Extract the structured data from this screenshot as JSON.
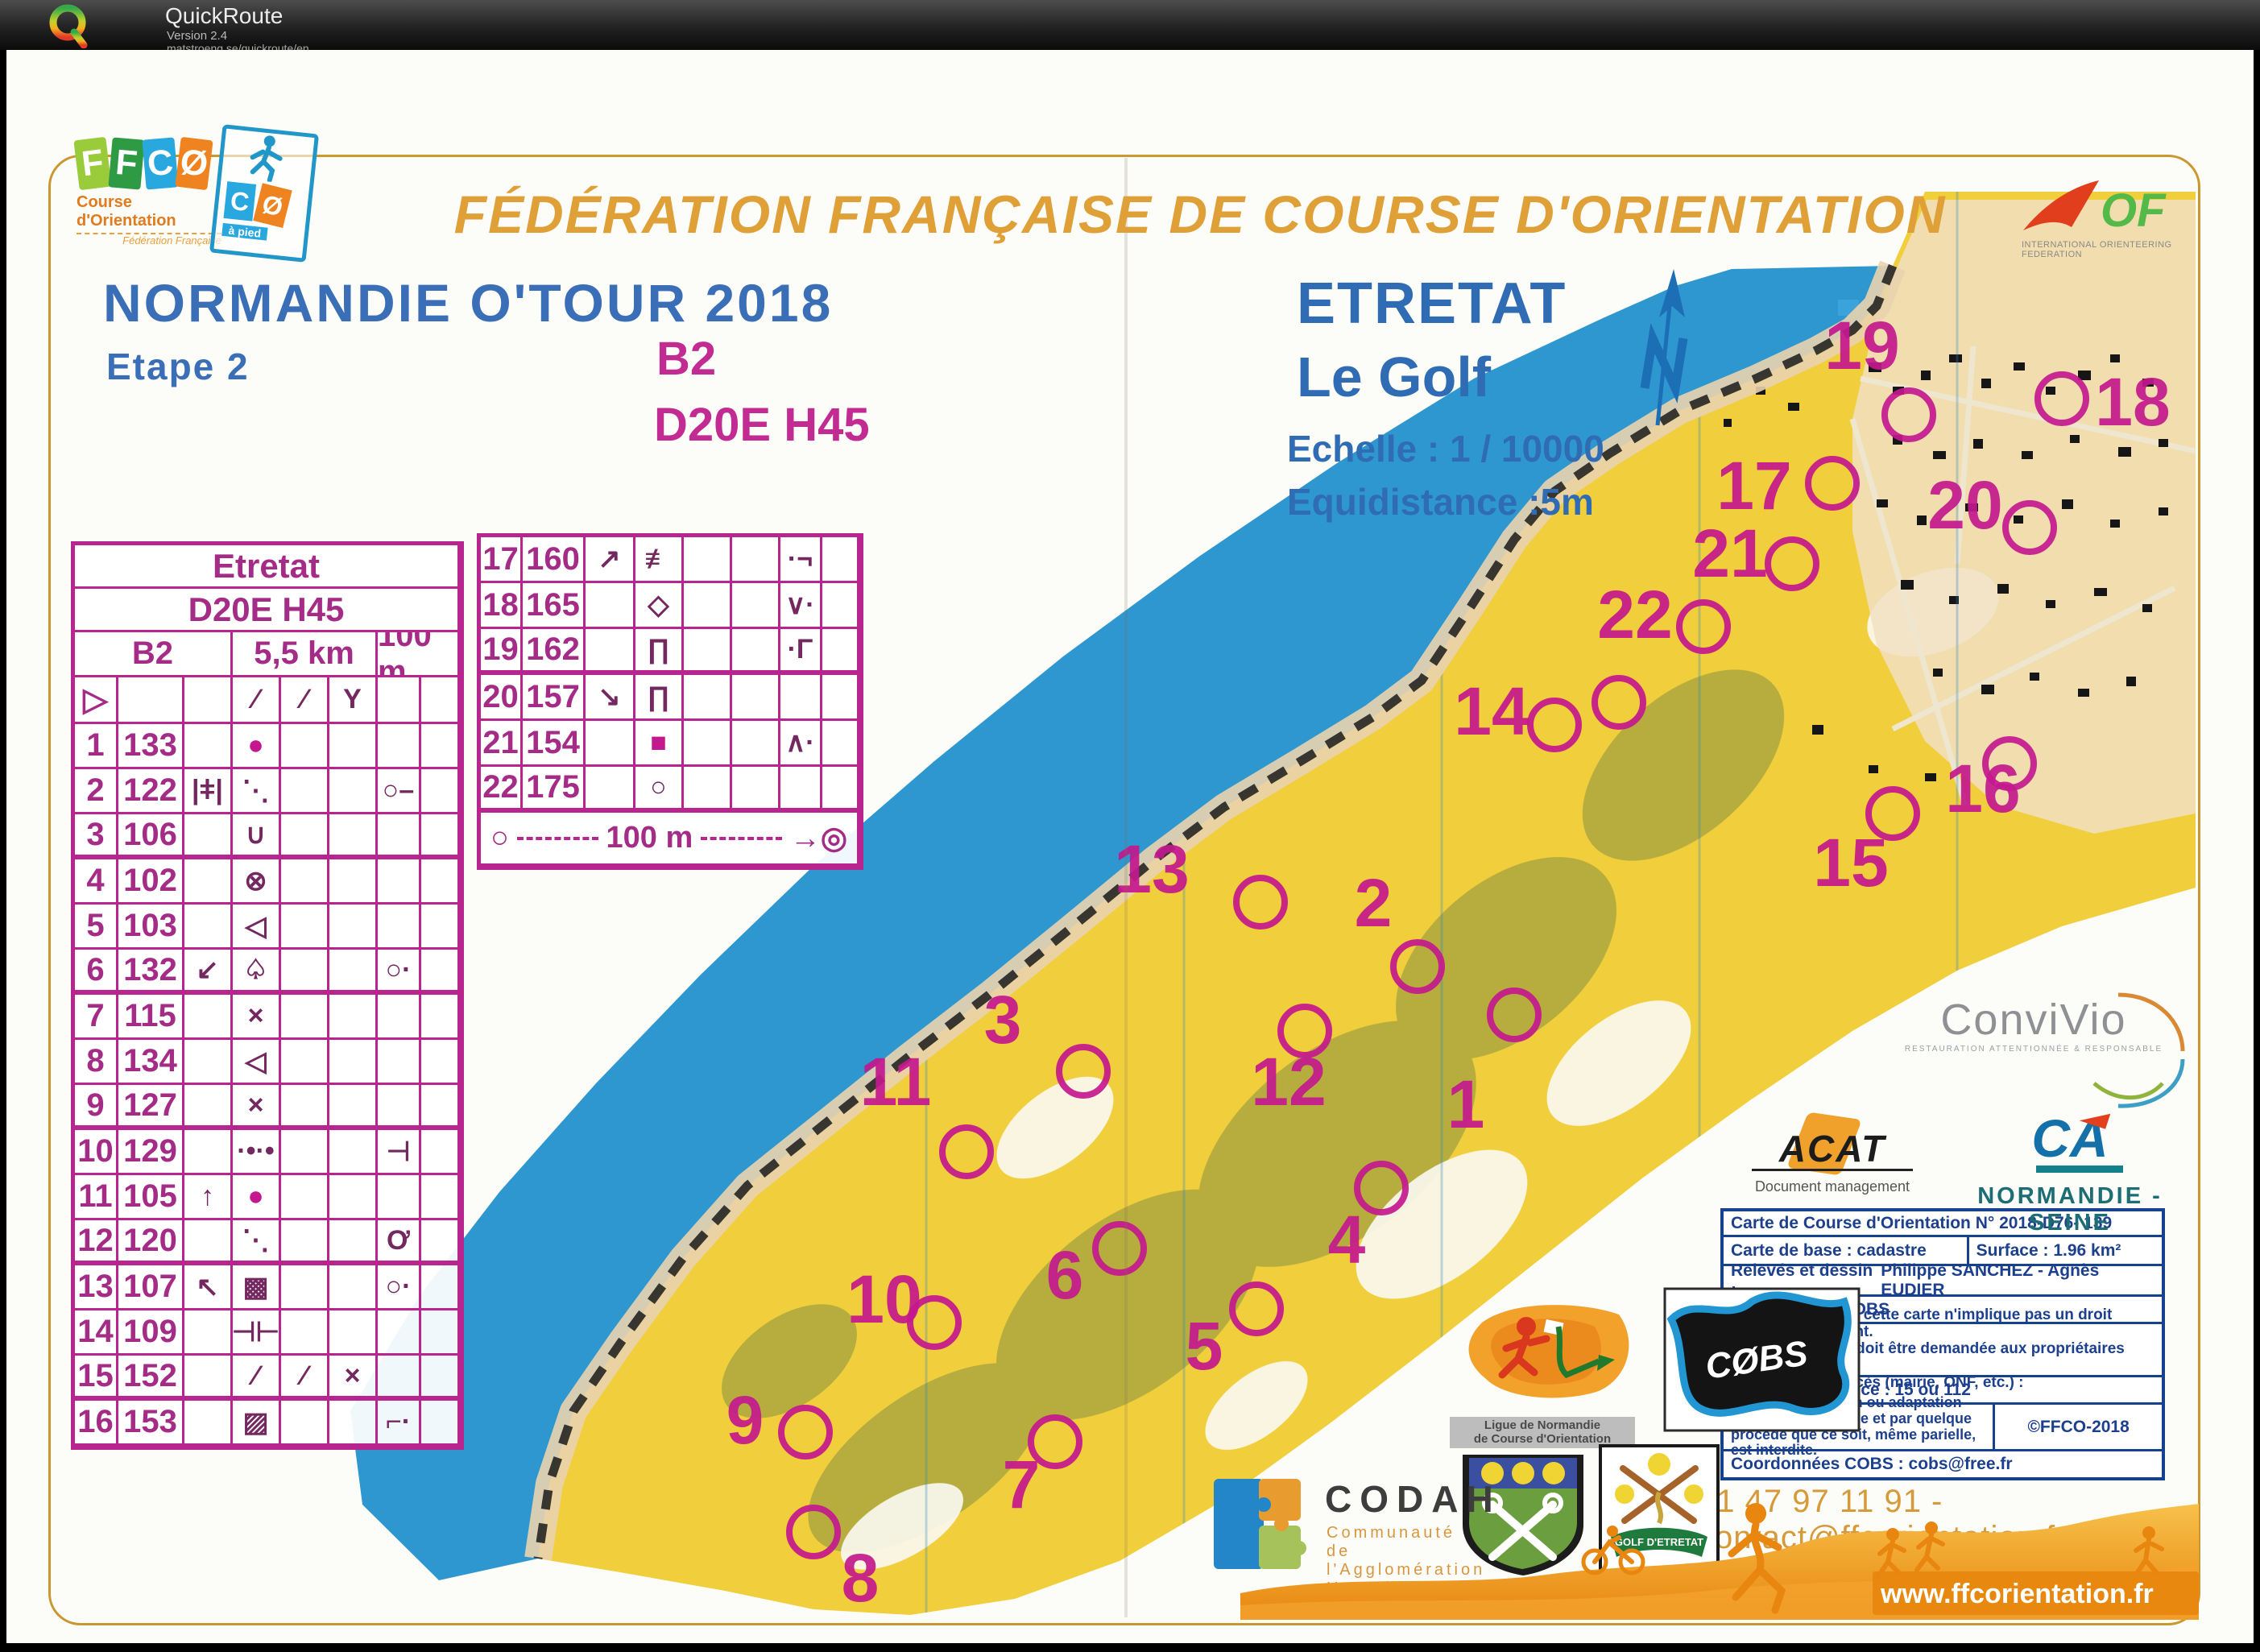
{
  "app": {
    "name": "QuickRoute",
    "version": "Version 2.4",
    "url": "matstroeng.se/quickroute/en"
  },
  "banner": {
    "title": "FÉDÉRATION FRANÇAISE DE COURSE D'ORIENTATION"
  },
  "ffco_logo": {
    "letters": [
      "F",
      "F",
      "C",
      "Ø"
    ],
    "caption1": "Course d'Orientation",
    "caption2": "Fédération Française"
  },
  "co_logo": {
    "letters": [
      "C",
      "Ø"
    ],
    "caption": "à pied"
  },
  "iof_logo": {
    "text": "OF",
    "caption": "INTERNATIONAL ORIENTEERING FEDERATION"
  },
  "event": {
    "title": "NORMANDIE O'TOUR  2018",
    "stage": "Etape 2",
    "course": "B2",
    "category": "D20E H45"
  },
  "map_title": {
    "name": "ETRETAT",
    "area": "Le Golf",
    "scale": "Echelle : 1 / 10000",
    "equidistance": "Equidistance :5m"
  },
  "control_card": {
    "title": "Etretat",
    "category": "D20E H45",
    "course": "B2",
    "length": "5,5 km",
    "climb": "100 m",
    "start": {
      "a": "▷",
      "d": "∕",
      "e": "∕",
      "f": "Y"
    },
    "rows": [
      {
        "n": "1",
        "k": "133",
        "c": "",
        "d": "●",
        "e": "",
        "f": "",
        "g": "",
        "h": ""
      },
      {
        "n": "2",
        "k": "122",
        "c": "|ǂ|",
        "d": "⋱",
        "e": "",
        "f": "",
        "g": "○–",
        "h": ""
      },
      {
        "n": "3",
        "k": "106",
        "c": "",
        "d": "∪",
        "e": "",
        "f": "",
        "g": "",
        "h": ""
      },
      {
        "n": "4",
        "k": "102",
        "c": "",
        "d": "⊗",
        "e": "",
        "f": "",
        "g": "",
        "h": ""
      },
      {
        "n": "5",
        "k": "103",
        "c": "",
        "d": "◁",
        "e": "",
        "f": "",
        "g": "",
        "h": ""
      },
      {
        "n": "6",
        "k": "132",
        "c": "↙",
        "d": "♤",
        "e": "",
        "f": "",
        "g": "○·",
        "h": ""
      },
      {
        "n": "7",
        "k": "115",
        "c": "",
        "d": "×",
        "e": "",
        "f": "",
        "g": "",
        "h": ""
      },
      {
        "n": "8",
        "k": "134",
        "c": "",
        "d": "◁",
        "e": "",
        "f": "",
        "g": "",
        "h": ""
      },
      {
        "n": "9",
        "k": "127",
        "c": "",
        "d": "×",
        "e": "",
        "f": "",
        "g": "",
        "h": ""
      },
      {
        "n": "10",
        "k": "129",
        "c": "",
        "d": "·•·•",
        "e": "",
        "f": "",
        "g": "⊣",
        "h": ""
      },
      {
        "n": "11",
        "k": "105",
        "c": "↑",
        "d": "●",
        "e": "",
        "f": "",
        "g": "",
        "h": ""
      },
      {
        "n": "12",
        "k": "120",
        "c": "",
        "d": "⋱",
        "e": "",
        "f": "",
        "g": "Ơ",
        "h": ""
      },
      {
        "n": "13",
        "k": "107",
        "c": "↖",
        "d": "▩",
        "e": "",
        "f": "",
        "g": "○·",
        "h": ""
      },
      {
        "n": "14",
        "k": "109",
        "c": "",
        "d": "⊣⊢",
        "e": "",
        "f": "",
        "g": "",
        "h": ""
      },
      {
        "n": "15",
        "k": "152",
        "c": "",
        "d": "∕",
        "e": "∕",
        "f": "×",
        "g": "",
        "h": ""
      },
      {
        "n": "16",
        "k": "153",
        "c": "",
        "d": "▨",
        "e": "",
        "f": "",
        "g": "⌐·",
        "h": ""
      }
    ]
  },
  "control_card2": {
    "rows": [
      {
        "n": "17",
        "k": "160",
        "c": "↗",
        "d": "≢",
        "e": "",
        "f": "",
        "g": "·¬",
        "h": ""
      },
      {
        "n": "18",
        "k": "165",
        "c": "",
        "d": "◇",
        "e": "",
        "f": "",
        "g": "∨·",
        "h": ""
      },
      {
        "n": "19",
        "k": "162",
        "c": "",
        "d": "∏",
        "e": "",
        "f": "",
        "g": "·Γ",
        "h": ""
      },
      {
        "n": "20",
        "k": "157",
        "c": "↘",
        "d": "∏",
        "e": "",
        "f": "",
        "g": "",
        "h": ""
      },
      {
        "n": "21",
        "k": "154",
        "c": "",
        "d": "■",
        "e": "",
        "f": "",
        "g": "∧·",
        "h": ""
      },
      {
        "n": "22",
        "k": "175",
        "c": "",
        "d": "○",
        "e": "",
        "f": "",
        "g": "",
        "h": ""
      }
    ],
    "scale_bar": {
      "start": "○",
      "label": "100 m",
      "finish": "→◎"
    }
  },
  "publisher": {
    "r1": "Carte de Course d'Orientation N° 2018-D76- 139",
    "r2a": "Carte de base : cadastre",
    "r2b": "Surface :   1.96 km²",
    "r3a": "Relevés et dessin :",
    "r3b": "Philippe SANCHEZ - Agnès EUDIER",
    "r4": "Distribution : COBS",
    "r5a": "La possession de cette carte n'implique pas un droit d'accès permanent.",
    "r5b": "Une autorisation doit être demandée aux propriétaires des terrains.",
    "r5c": "Autorisation d'accès (mairie, ONF, etc.) :",
    "r6": "Numéro d'urgence : 15 ou 112",
    "r7a": "Toute reproduction ou adaptation sous quelque forme et par quelque procédé que ce soit, même parielle, est interdite.",
    "r7b": "©FFCO-2018",
    "r8": "Coordonnées COBS : cobs@free.fr"
  },
  "contact": "01 47 97 11 91 - contact@ffcorientation.fr",
  "website": "www.ffcorientation.fr",
  "logos": {
    "convivio": {
      "name": "ConviVio",
      "caption": "RESTAURATION ATTENTIONNÉE & RESPONSABLE"
    },
    "acat": {
      "name": "ACAT",
      "caption": "Document management"
    },
    "ca": {
      "name": "CA",
      "caption": "NORMANDIE - SEINE"
    },
    "ligue": {
      "caption1": "Ligue de Normandie",
      "caption2": "de Course d'Orientation"
    },
    "cobs": {
      "name": "CØBS"
    },
    "codah": {
      "name": "CODAH",
      "caption1": "Communauté de",
      "caption2": "l'Agglomération Havraise"
    },
    "golf": {
      "banner": "GOLF D'ETRETAT"
    }
  },
  "map": {
    "control_labels": [
      "1",
      "2",
      "3",
      "4",
      "5",
      "6",
      "7",
      "8",
      "9",
      "10",
      "11",
      "12",
      "13",
      "14",
      "15",
      "16",
      "17",
      "18",
      "19",
      "20",
      "21",
      "22"
    ],
    "colors": {
      "sea": "#2e97d0",
      "land": "#f1ce3b",
      "olive": "#a8a540",
      "control": "#c4188e",
      "cliff_sand": "#e9d3ae",
      "border_gold": "#c9982f",
      "headline_blue": "#3a6fb7",
      "magenta": "#c22b92",
      "title_orange": "#dfa038"
    }
  }
}
